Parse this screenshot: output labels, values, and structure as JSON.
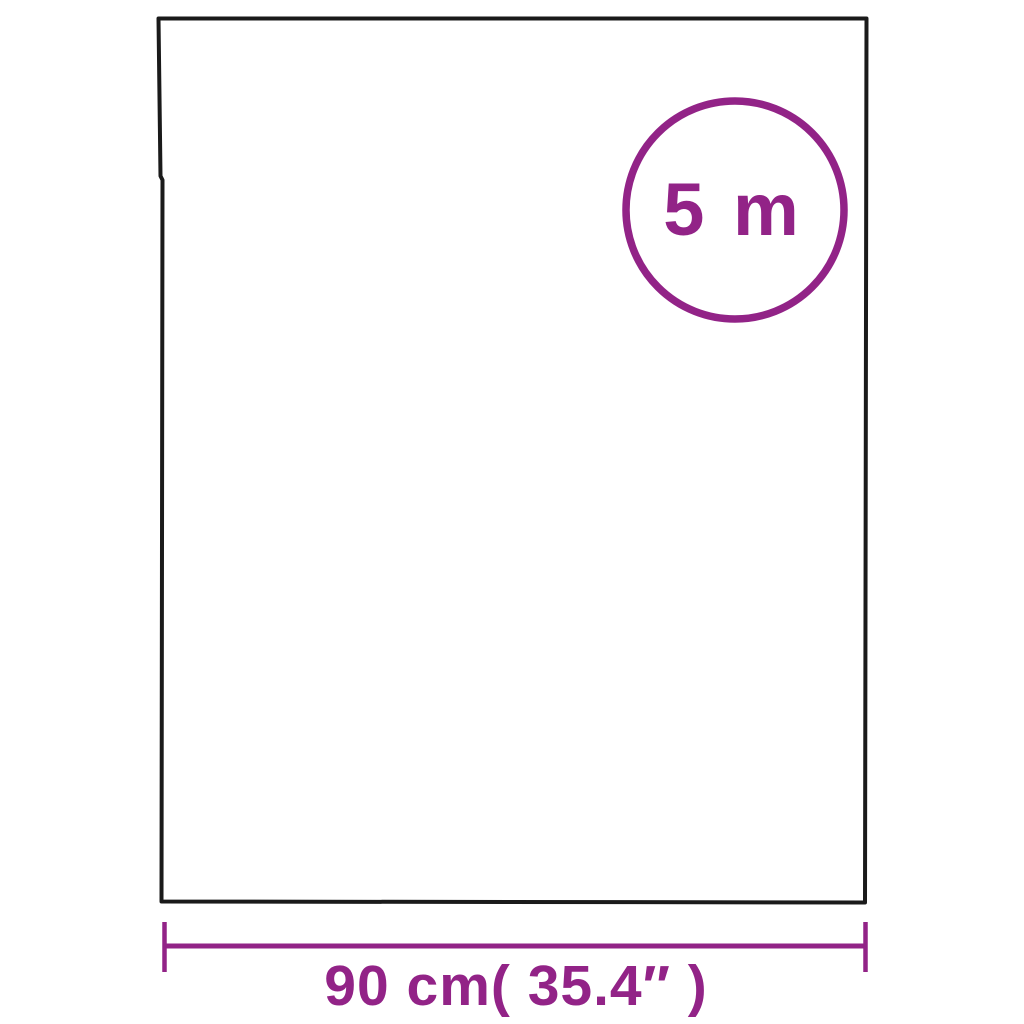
{
  "figure": {
    "type": "product-dimension-diagram",
    "badge": {
      "label": "5 m"
    },
    "dimension": {
      "width_label": "90 cm( 35.4″ )"
    },
    "colors": {
      "accent": "#922387",
      "outline": "#1a1a1a",
      "background": "#ffffff"
    }
  }
}
